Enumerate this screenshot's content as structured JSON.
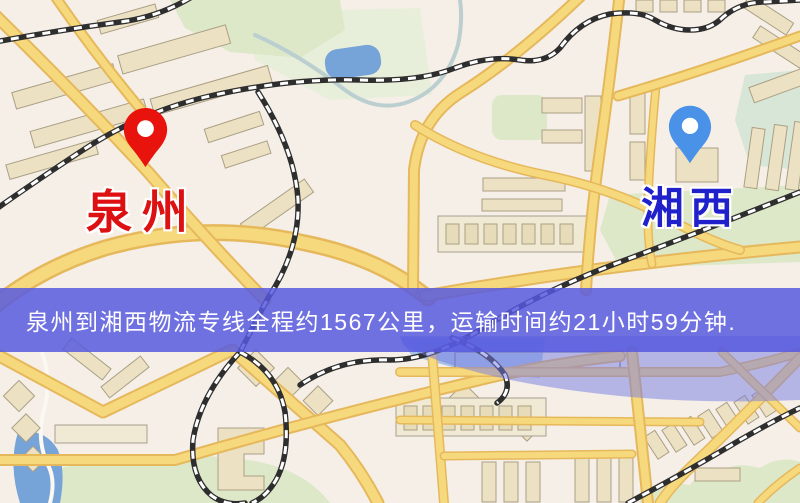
{
  "banner": {
    "text": "泉州到湘西物流专线全程约1567公里，运输时间约21小时59分钟.",
    "bg_color": "rgba(86,88,224,0.84)",
    "text_color": "#ffffff"
  },
  "markers": {
    "origin": {
      "name": "泉州",
      "pin_color": "#e8130c",
      "label_color": "#dd1111"
    },
    "destination": {
      "name": "湘西",
      "pin_color": "#4a92e8",
      "label_color": "#2121cc"
    }
  },
  "map_colors": {
    "background": "#f5efe7",
    "road_fill": "#f7d97d",
    "road_casing": "#e6b85c",
    "park": "#dde8c9",
    "water": "#76a3d8",
    "building": "#ece2c3",
    "railway": "#2e2e2e"
  }
}
